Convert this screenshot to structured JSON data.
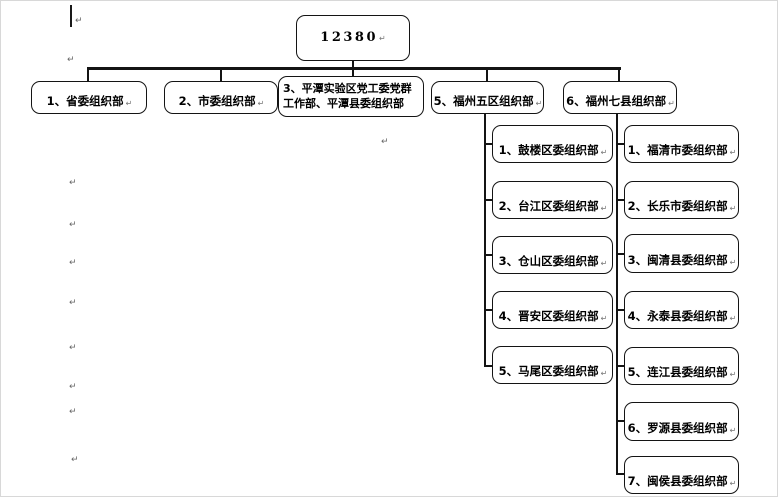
{
  "org_chart": {
    "root": {
      "label": "12380"
    },
    "level2": [
      {
        "label": "1、省委组织部"
      },
      {
        "label": "2、市委组织部"
      },
      {
        "label": "3、平潭实验区党工委党群工作部、平潭县委组织部"
      },
      {
        "label": "5、福州五区组织部"
      },
      {
        "label": "6、福州七县组织部"
      }
    ],
    "fuzhou_five_districts": [
      {
        "label": "1、鼓楼区委组织部"
      },
      {
        "label": "2、台江区委组织部"
      },
      {
        "label": "3、仓山区委组织部"
      },
      {
        "label": "4、晋安区委组织部"
      },
      {
        "label": "5、马尾区委组织部"
      }
    ],
    "fuzhou_seven_counties": [
      {
        "label": "1、福清市委组织部"
      },
      {
        "label": "2、长乐市委组织部"
      },
      {
        "label": "3、闽清县委组织部"
      },
      {
        "label": "4、永泰县委组织部"
      },
      {
        "label": "5、连江县委组织部"
      },
      {
        "label": "6、罗源县委组织部"
      },
      {
        "label": "7、闽侯县委组织部"
      }
    ]
  },
  "marks": {
    "return_glyph": "↵"
  }
}
